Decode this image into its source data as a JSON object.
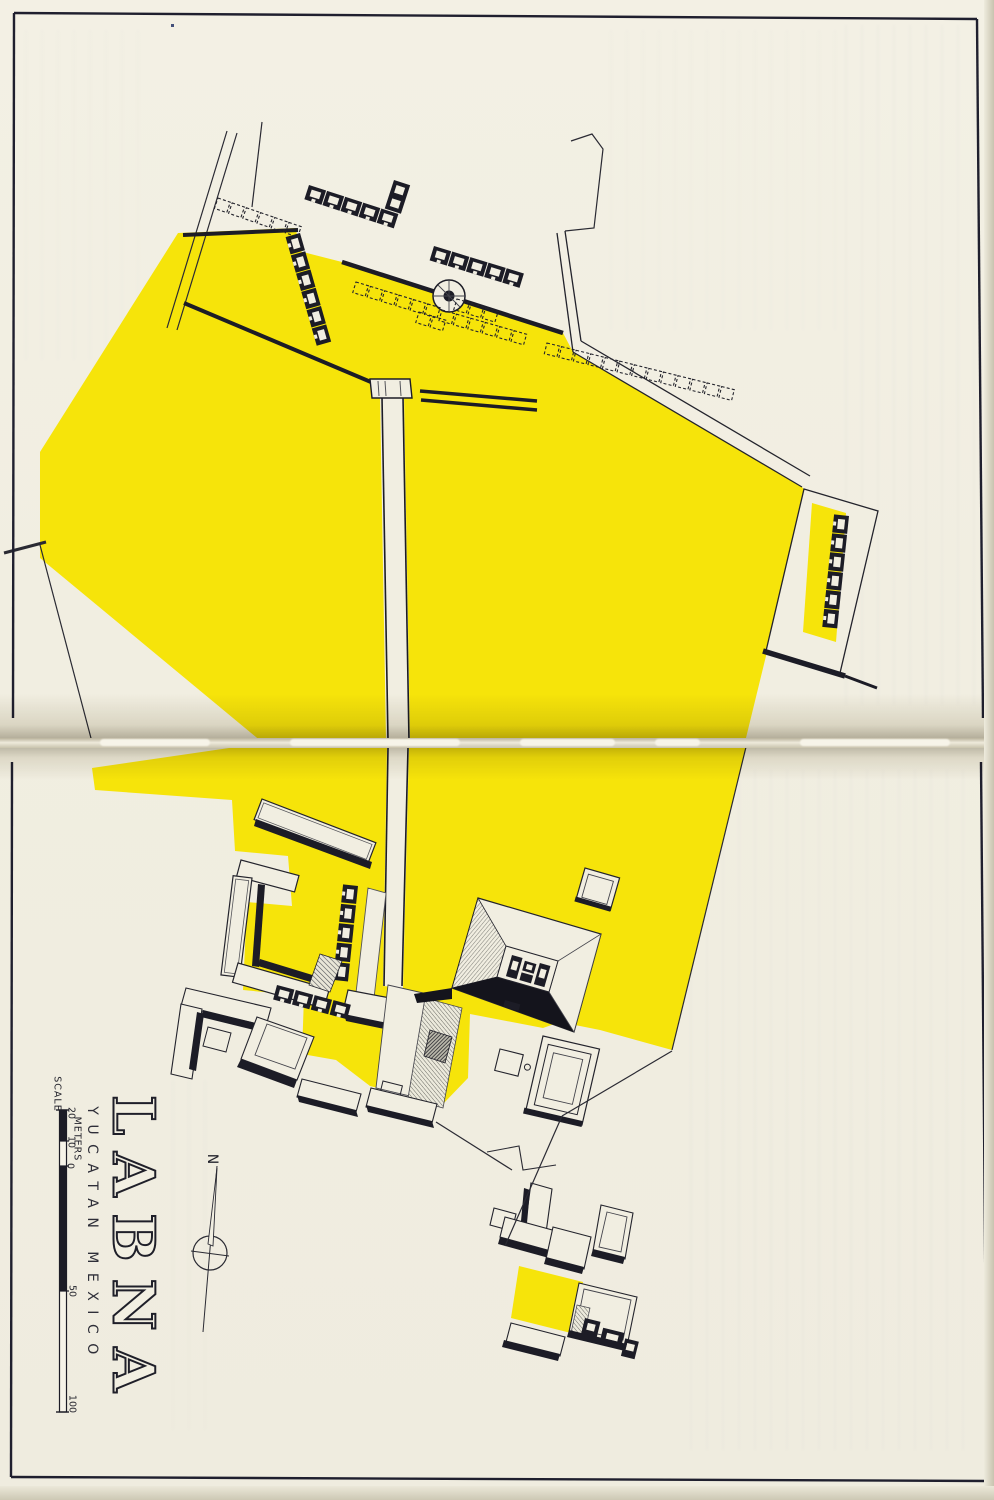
{
  "document": {
    "title": "LABNA",
    "subtitle": "YUCATAN MEXICO"
  },
  "north_arrow": {
    "label": "N"
  },
  "scale_bar": {
    "label": "SCALE",
    "units": "METERS",
    "ticks": [
      "20",
      "10",
      "0",
      "50",
      "100"
    ]
  },
  "colors": {
    "paper": "#f1eee1",
    "plaza_yellow": "#f6e40a",
    "ink": "#1c1c26",
    "hatch_gray": "#85857e"
  }
}
